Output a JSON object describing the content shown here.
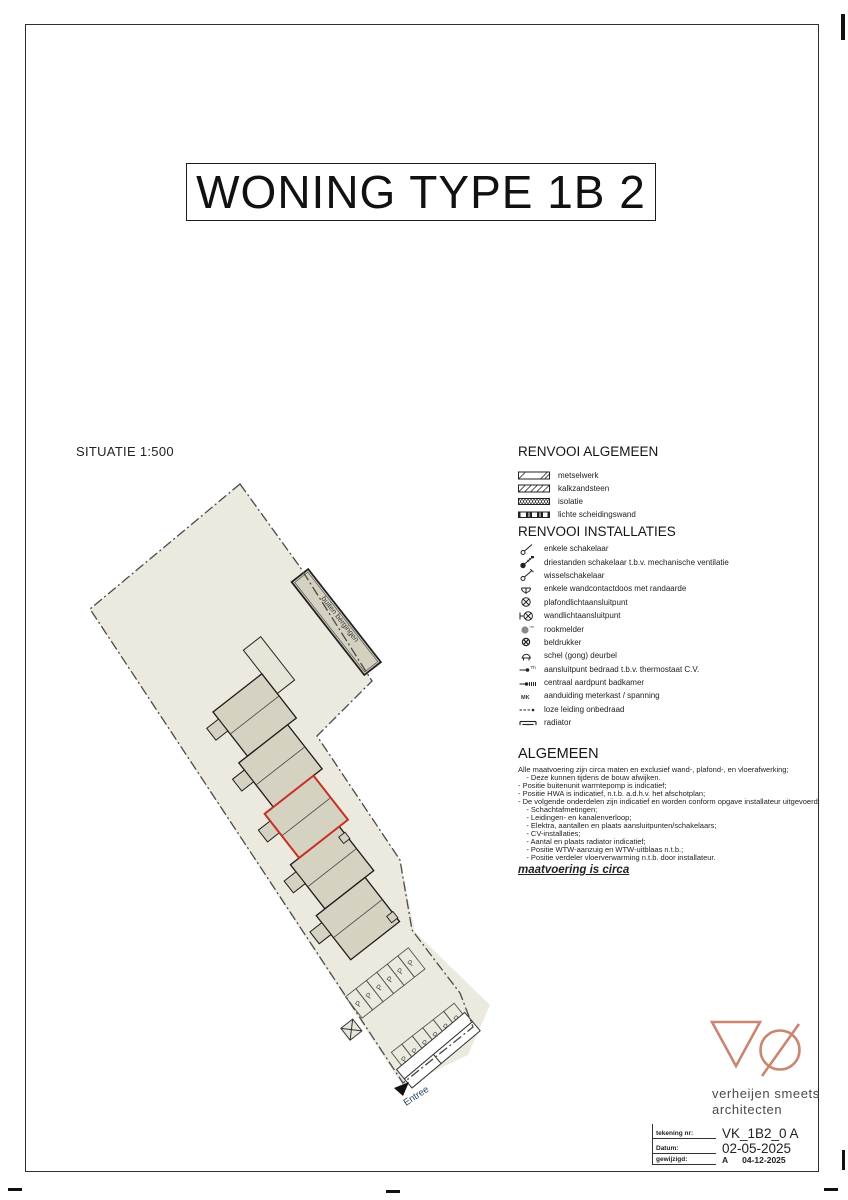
{
  "title": "WONING TYPE 1B 2",
  "situatie": {
    "label": "SITUATIE 1:500",
    "buiten_bergingen_label": "buiten bergingen",
    "entree_label": "Entree",
    "parking_letter": "P"
  },
  "renvooi_algemeen": {
    "heading": "RENVOOI ALGEMEEN",
    "items": [
      {
        "symbol": "metselwerk-hatch",
        "label": "metselwerk"
      },
      {
        "symbol": "kalkzandsteen-hatch",
        "label": "kalkzandsteen"
      },
      {
        "symbol": "isolatie-hatch",
        "label": "isolatie"
      },
      {
        "symbol": "lichte-scheidingswand-hatch",
        "label": "lichte scheidingswand"
      }
    ]
  },
  "renvooi_installaties": {
    "heading": "RENVOOI INSTALLATIES",
    "items": [
      {
        "symbol": "switch-single-icon",
        "label": "enkele schakelaar"
      },
      {
        "symbol": "switch-three-position-icon",
        "label": "driestanden schakelaar t.b.v. mechanische ventilatie"
      },
      {
        "symbol": "switch-two-way-icon",
        "label": "wisselschakelaar"
      },
      {
        "symbol": "socket-earthed-icon",
        "label": "enkele wandcontactdoos met randaarde"
      },
      {
        "symbol": "ceiling-light-icon",
        "label": "plafondlichtaansluitpunt"
      },
      {
        "symbol": "wall-light-icon",
        "label": "wandlichtaansluitpunt"
      },
      {
        "symbol": "smoke-detector-icon",
        "label": "rookmelder"
      },
      {
        "symbol": "bell-push-icon",
        "label": "beldrukker"
      },
      {
        "symbol": "doorbell-gong-icon",
        "label": "schel (gong) deurbel"
      },
      {
        "symbol": "thermostat-connection-icon",
        "label": "aansluitpunt bedraad t.b.v. thermostaat C.V."
      },
      {
        "symbol": "earth-point-icon",
        "label": "centraal aardpunt badkamer"
      },
      {
        "symbol": "meter-cabinet-icon",
        "label": "aanduiding meterkast / spanning"
      },
      {
        "symbol": "empty-conduit-icon",
        "label": "loze leiding onbedraad"
      },
      {
        "symbol": "radiator-icon",
        "label": "radiator"
      }
    ]
  },
  "algemeen": {
    "heading": "ALGEMEEN",
    "lines": [
      "Alle maatvoering zijn circa maten en exclusief wand-, plafond-, en vloerafwerking;",
      "    - Deze kunnen tijdens de bouw afwijken.",
      "- Positie buitenunit warmtepomp is indicatief;",
      "- Positie HWA is indicatief, n.t.b. a.d.h.v. het afschotplan;",
      "- De volgende onderdelen zijn indicatief en worden conform opgave installateur uitgevoerd:",
      "    - Schachtafmetingen;",
      "    - Leidingen- en kanalenverloop;",
      "    - Elektra, aantallen en plaats aansluitpunten/schakelaars;",
      "    - CV-installaties;",
      "    - Aantal en plaats radiator indicatief;",
      "    - Positie WTW-aanzuig en WTW-uitblaas n.t.b.;",
      "    - Positie verdeler vloerverwarming n.t.b. door installateur."
    ],
    "note": "maatvoering is circa"
  },
  "titleblock": {
    "firm_line1": "verheijen smeets",
    "firm_line2": "architecten",
    "rows": [
      {
        "label": "tekening nr:",
        "value": "VK_1B2_0 A"
      },
      {
        "label": "Datum:",
        "value": "02-05-2025"
      },
      {
        "label": "gewijzigd:",
        "value": "A",
        "value2": "04-12-2025"
      }
    ]
  },
  "colors": {
    "logo_accent": "#c98670",
    "highlighted_unit": "#c53225",
    "parcel_fill": "#eceade",
    "building_fill": "#d6d2c1"
  }
}
